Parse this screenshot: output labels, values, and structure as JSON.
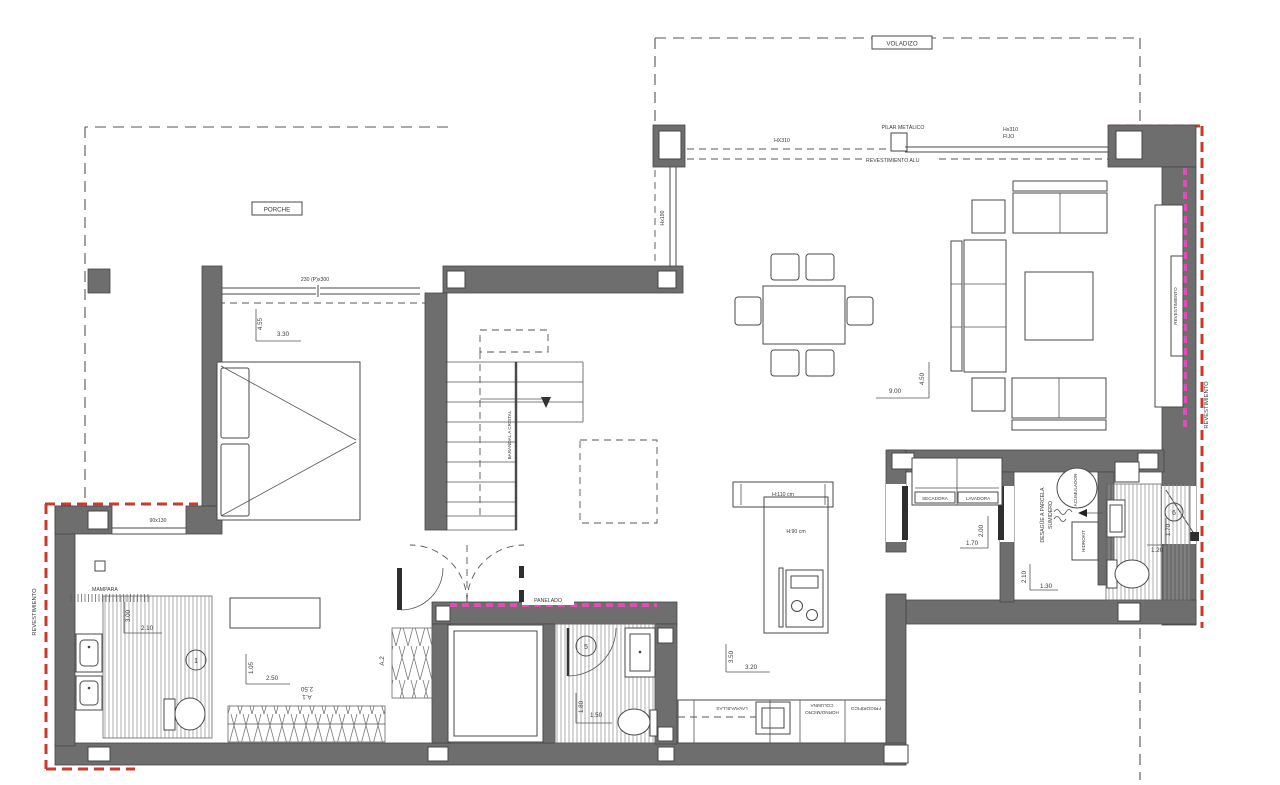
{
  "labels": {
    "voladizo": "VOLADIZO",
    "pilar_metalico": "PILAR METÁLICO",
    "hx310": "HX310",
    "hx310_fijo_l1": "Hx310",
    "hx310_fijo_l2": "FIJO",
    "revestimiento_alu": "REVESTIMIENTO ALU",
    "porche": "PORCHE",
    "hx190": "Hx190",
    "puerta_230": "230 (P)x300",
    "barandal": "BARANDAL A CRISTAL",
    "revestimiento_left": "REVESTIMIENTO",
    "revestimiento_right_outer": "REVESTIMIENTO",
    "revestimiento_right_inner": "REVESTIMIENTO",
    "mampara": "MAMPARA",
    "ventana_90x130": "90x130",
    "panelado": "PANELADO",
    "h110": "H:110 cm",
    "h90": "H:90 cm",
    "secadora": "SECADORA",
    "lavadora": "LAVADORA",
    "sumidero_l1": "SUMIDERO",
    "sumidero_l2": "DESAGÜE A PARCELA",
    "acumulador": "ACUMULADOR",
    "hidrokit": "HIDROKIT",
    "lavavajillas": "LAVAVAJILLAS",
    "columna_l1": "COLUMNA",
    "columna_l2": "HORNO/MICRO",
    "frigorifico": "FRIGORÍFICO"
  },
  "dims": {
    "bedroom_v": "4.55",
    "bedroom_h": "3.30",
    "living_w": "9.00",
    "living_d": "4.50",
    "laundry_w": "1.70",
    "laundry_d": "2.00",
    "tech_d": "2.10",
    "tech_w": "1.30",
    "bath6_d": "1.70",
    "bath6_w": "1.20",
    "bath1_d": "3.00",
    "bath1_w": "2.10",
    "dressing_d": "1.05",
    "dressing_w": "2.50",
    "door_a1_w": "2.50",
    "door_a1": "A.1",
    "door_a2": "A.2",
    "bath5_d": "1.80",
    "bath5_w": "1.50",
    "kitchen_d": "3.50",
    "kitchen_w": "3.20"
  },
  "rooms": {
    "bath1": "1",
    "bath5": "5",
    "bath6": "6"
  },
  "colors": {
    "wall": "#6e6e6e",
    "red_dash": "#cf392a",
    "magenta_dash": "#e14db8",
    "line": "#4a4a4a",
    "text": "#3a3a3a"
  }
}
